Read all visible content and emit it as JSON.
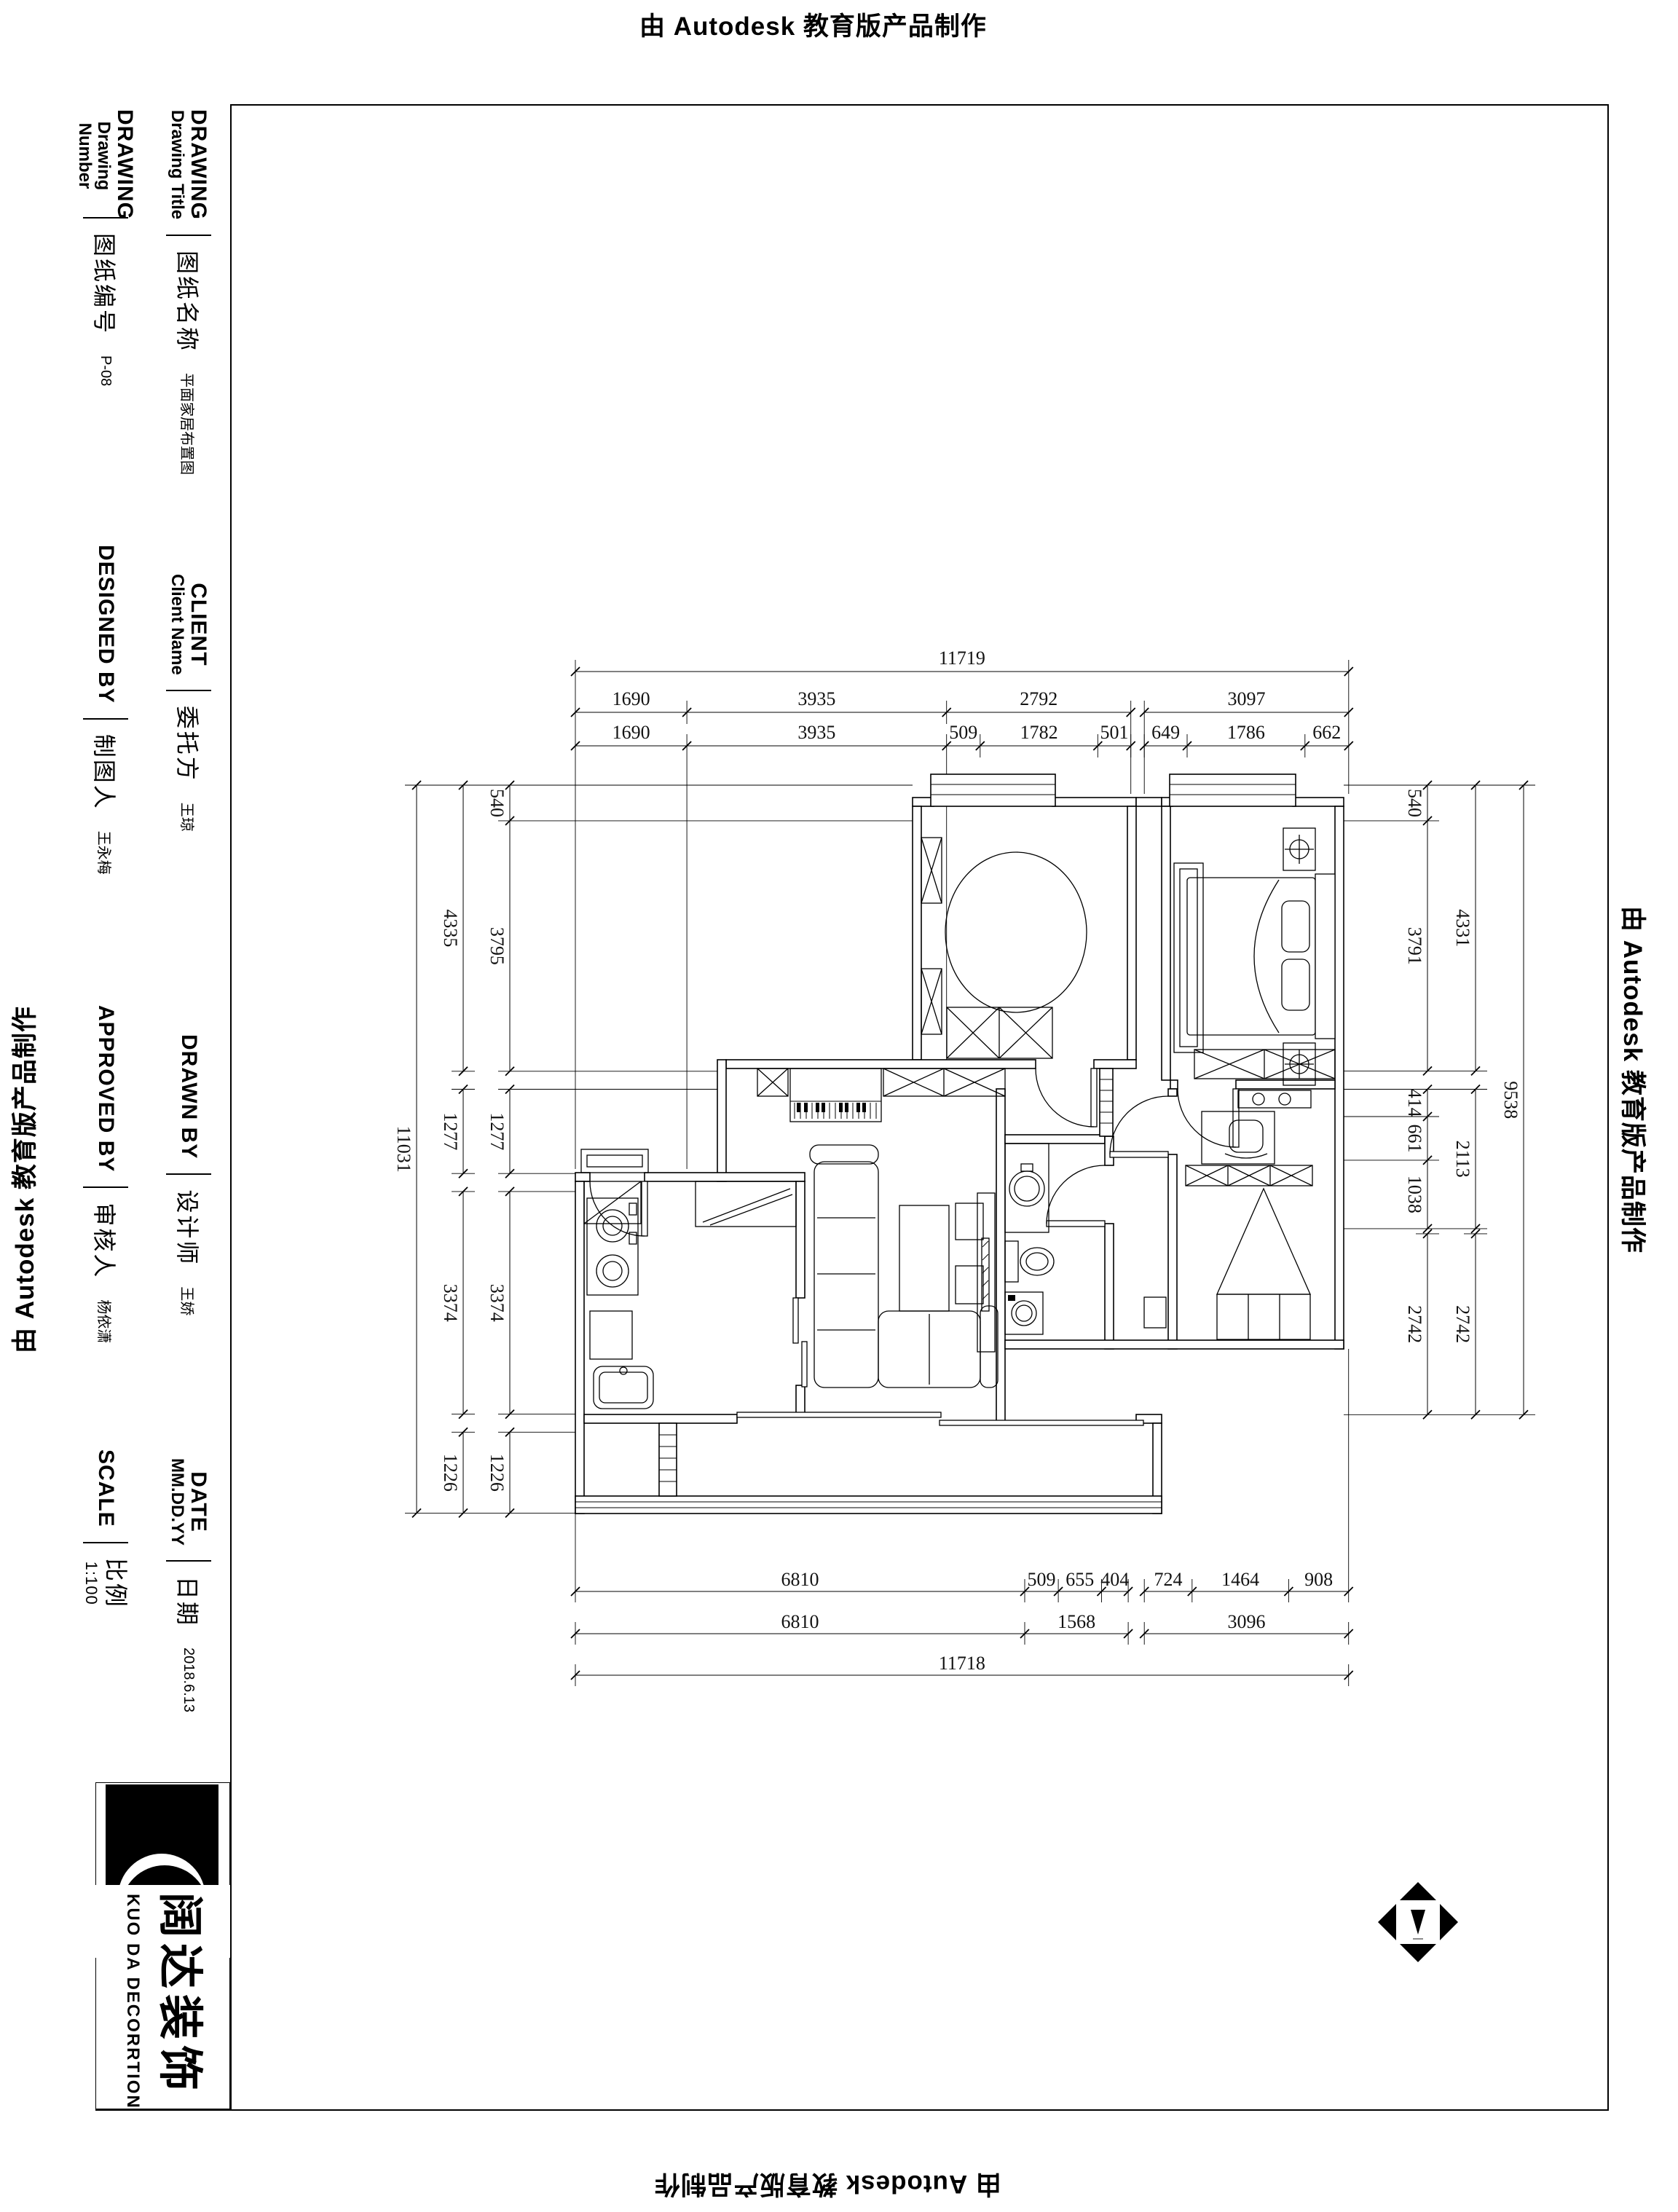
{
  "edge_labels": {
    "top": "由 Autodesk 教育版产品制作",
    "bottom": "由 Autodesk 教育版产品制作",
    "left": "由 Autodesk 教育版产品制作",
    "right": "由 Autodesk 教育版产品制作"
  },
  "title_block": {
    "sections": {
      "drawing_title": {
        "en_bold": "DRAWING",
        "en_sub": "Drawing Title",
        "cn": "图纸名称",
        "value": "平面家居布置图"
      },
      "drawing_number": {
        "en_bold": "DRAWING",
        "en_sub": "Drawing Number",
        "cn": "图纸编号",
        "value": "P-08"
      },
      "client": {
        "en_bold": "CLIENT",
        "en_sub": "Client Name",
        "cn": "委托方",
        "value": "王琼"
      },
      "designed_by": {
        "en_bold": "DESIGNED BY",
        "cn": "制图人",
        "value": "王永梅"
      },
      "drawn_by": {
        "en_bold": "DRAWN  BY",
        "cn": "设计师",
        "value": "王娇"
      },
      "approved_by": {
        "en_bold": "APPROVED BY",
        "cn": "审核人",
        "value": "杨依潇"
      },
      "date": {
        "en_bold": "DATE",
        "en_sub": "MM.DD.YY",
        "cn": "日期",
        "value": "2018.6.13"
      },
      "scale": {
        "en_bold": "SCALE",
        "cn": "比例",
        "value": "1:100"
      }
    },
    "logo": {
      "cn": "阔达装饰",
      "en": "KUO DA DECORRTION"
    }
  },
  "dims": {
    "top": {
      "total": "11719",
      "row2": [
        "1690",
        "3935",
        "2792",
        "3097"
      ],
      "row3": [
        "1690",
        "3935",
        "509",
        "1782",
        "501",
        "649",
        "1786",
        "662"
      ]
    },
    "bottom": {
      "total": "11718",
      "row1": [
        "6810",
        "509",
        "655",
        "404",
        "724",
        "1464",
        "908"
      ],
      "row2": [
        "6810",
        "1568",
        "3096"
      ]
    },
    "left": {
      "total": "11031",
      "mid": [
        "4335",
        "1277",
        "3374",
        "1226"
      ],
      "inner": [
        "540",
        "3795",
        "1277",
        "3374",
        "1226"
      ]
    },
    "right": {
      "total": "9538",
      "mid": [
        "4331",
        "2113",
        "2742"
      ],
      "inner": [
        "540",
        "3791",
        "414",
        "661",
        "1038",
        "2742"
      ]
    }
  }
}
